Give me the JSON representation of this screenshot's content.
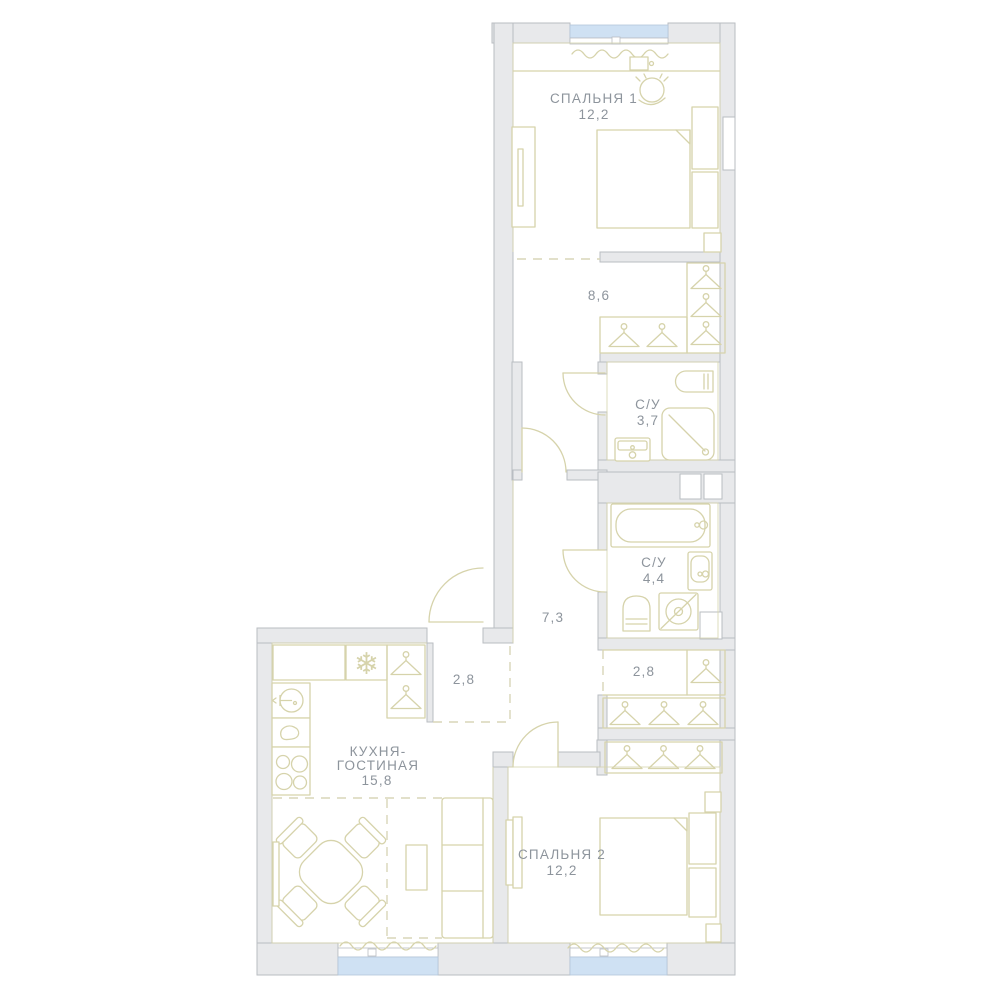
{
  "rooms": {
    "bedroom1": {
      "name": "СПАЛЬНЯ 1",
      "area": "12,2"
    },
    "hall": {
      "area": "8,6"
    },
    "bath1": {
      "name": "С/У",
      "area": "3,7"
    },
    "bath2": {
      "name": "С/У",
      "area": "4,4"
    },
    "corridor": {
      "area": "7,3"
    },
    "closet": {
      "area": "2,8"
    },
    "entry": {
      "area": "2,8"
    },
    "kitchen": {
      "name_line1": "КУХНЯ-",
      "name_line2": "ГОСТИНАЯ",
      "area": "15,8"
    },
    "bedroom2": {
      "name": "СПАЛЬНЯ 2",
      "area": "12,2"
    }
  },
  "icons": {
    "fridge": "❄"
  },
  "colors": {
    "wall_fill": "#e8e9eb",
    "wall_stroke": "#b9bdc2",
    "furniture": "#d6d3ab",
    "window_glass": "#cfe1f3",
    "window_stroke": "#b3c6da",
    "label": "#8d949c",
    "dashed": "#d9d6b8",
    "bg": "#ffffff"
  }
}
